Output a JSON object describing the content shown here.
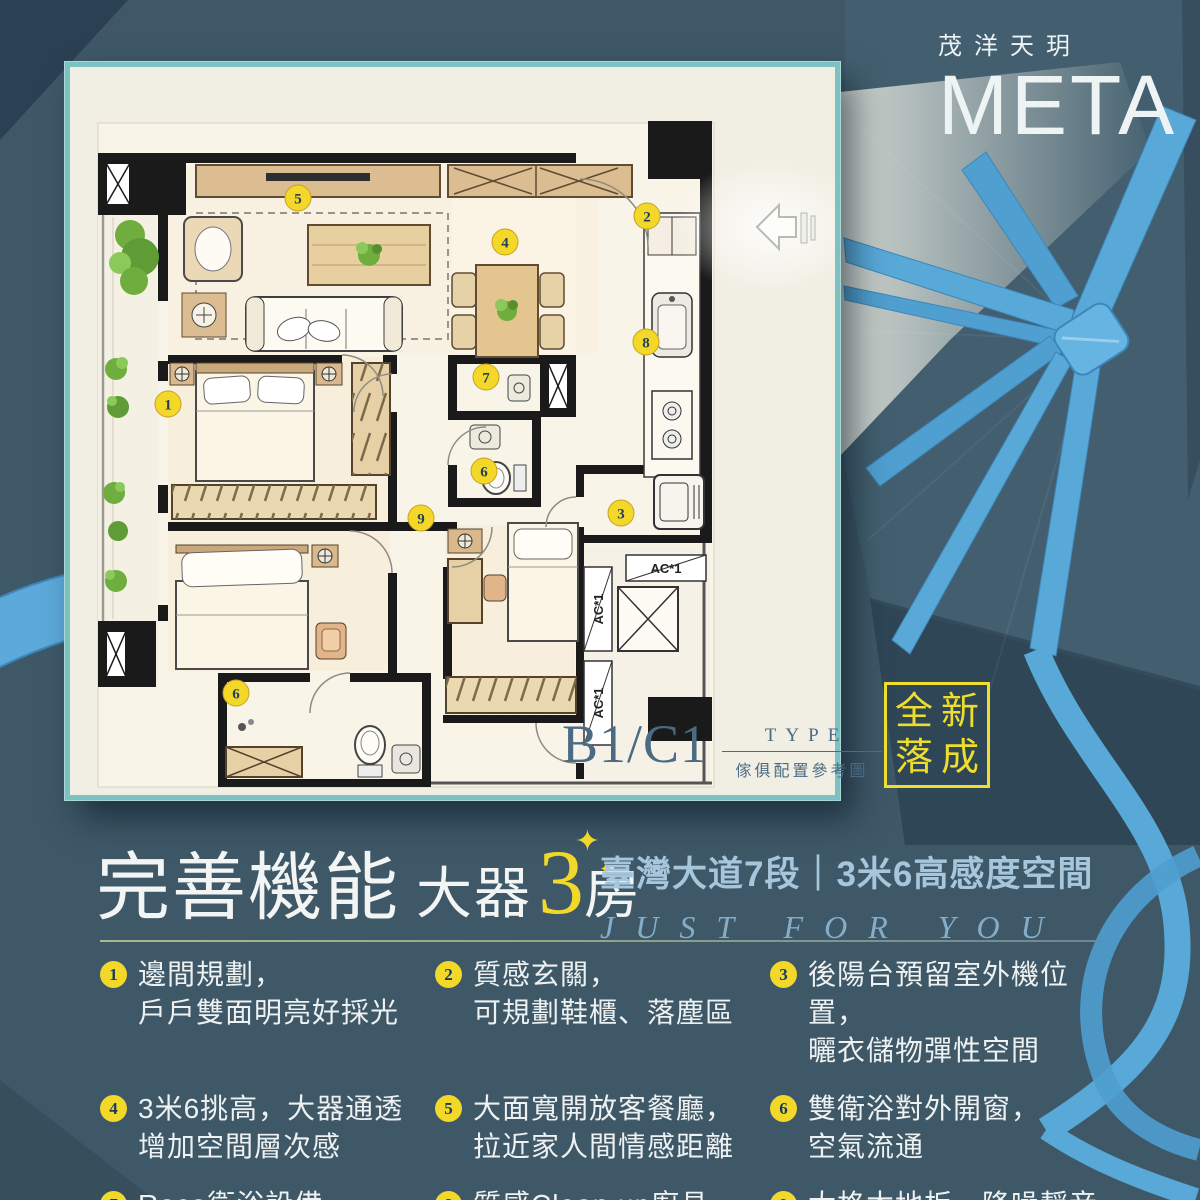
{
  "brand": {
    "zh": "茂洋天玥",
    "en": "META"
  },
  "badge": {
    "lines": [
      "全新",
      "落成"
    ]
  },
  "plan": {
    "type_code": "B1/C1",
    "type_label": "TYPE",
    "type_caption": "傢俱配置參考圖",
    "ac_label": "AC*1",
    "markers": [
      {
        "n": "5",
        "x": 228,
        "y": 131
      },
      {
        "n": "2",
        "x": 577,
        "y": 149
      },
      {
        "n": "4",
        "x": 435,
        "y": 175
      },
      {
        "n": "8",
        "x": 576,
        "y": 275
      },
      {
        "n": "7",
        "x": 416,
        "y": 310
      },
      {
        "n": "6",
        "x": 414,
        "y": 404
      },
      {
        "n": "9",
        "x": 351,
        "y": 451
      },
      {
        "n": "3",
        "x": 551,
        "y": 446
      },
      {
        "n": "1",
        "x": 98,
        "y": 337
      },
      {
        "n": "6",
        "x": 166,
        "y": 626
      }
    ]
  },
  "headline": {
    "lead": "完善機能",
    "mid": "大器",
    "num": "3",
    "tail": "房",
    "sparkle": "✦"
  },
  "subtitle": {
    "line": "臺灣大道7段｜3米6高感度空間",
    "tagline": "JUST FOR YOU"
  },
  "features": [
    {
      "num": "1",
      "l1": "邊間規劃，",
      "l2": "戶戶雙面明亮好採光"
    },
    {
      "num": "2",
      "l1": "質感玄關，",
      "l2": "可規劃鞋櫃、落塵區"
    },
    {
      "num": "3",
      "l1": "後陽台預留室外機位置，",
      "l2": "曬衣儲物彈性空間"
    },
    {
      "num": "4",
      "l1": "3米6挑高，大器通透",
      "l2": "增加空間層次感"
    },
    {
      "num": "5",
      "l1": "大面寬開放客餐廳，",
      "l2": "拉近家人間情感距離"
    },
    {
      "num": "6",
      "l1": "雙衛浴對外開窗，",
      "l2": "空氣流通"
    },
    {
      "num": "7",
      "l1": "Roca衛浴設備"
    },
    {
      "num": "8",
      "l1": "質感Clean up廚具"
    },
    {
      "num": "9",
      "l1": "太格木地板，降噪靜音"
    }
  ],
  "icons": {
    "entry_arrow": "left-arrow",
    "sparkle": "four-point-star"
  },
  "colors": {
    "background": "#3e5868",
    "ribbon_blue": "#58a8d8",
    "accent_yellow": "#f2d829",
    "subtitle_blue": "#a6c6dc",
    "card_border": "#7dc2c2",
    "card_bg": "#f1eee3",
    "plan_label": "#4a6b82",
    "wall_black": "#1a1a1a"
  }
}
